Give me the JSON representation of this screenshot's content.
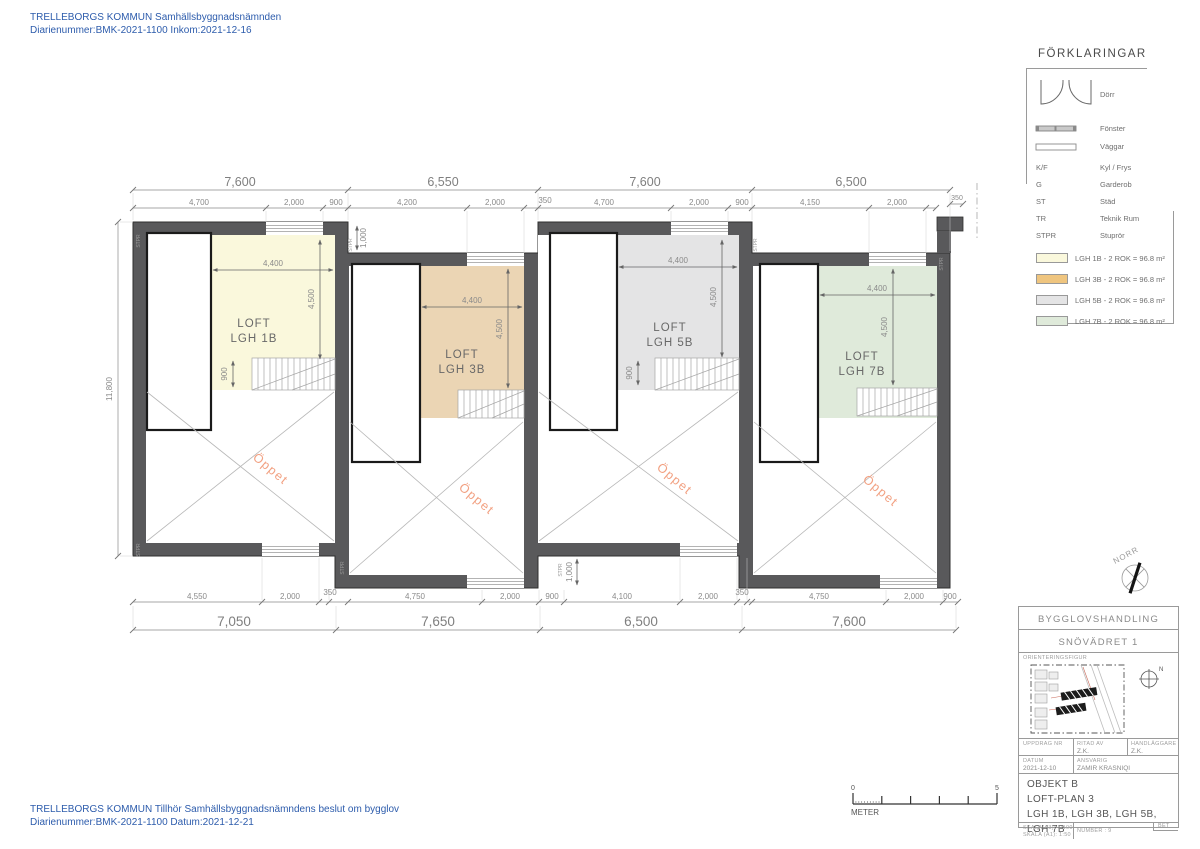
{
  "stamps": {
    "top": {
      "line1": "TRELLEBORGS KOMMUN Samhällsbyggnadsnämnden",
      "line2": "Diarienummer:BMK-2021-1100 Inkom:2021-12-16"
    },
    "bottom": {
      "line1": "TRELLEBORGS KOMMUN Tillhör Samhällsbyggnadsnämndens beslut om bygglov",
      "line2": "Diarienummer:BMK-2021-1100 Datum:2021-12-21"
    }
  },
  "legend": {
    "title": "FÖRKLARINGAR",
    "dorr": "Dörr",
    "fonster": "Fönster",
    "vaggar": "Väggar",
    "abbr": [
      {
        "key": "K/F",
        "value": "Kyl / Frys"
      },
      {
        "key": "G",
        "value": "Garderob"
      },
      {
        "key": "ST",
        "value": "Städ"
      },
      {
        "key": "TR",
        "value": "Teknik Rum"
      },
      {
        "key": "STPR",
        "value": "Stuprör"
      }
    ],
    "apartments": [
      {
        "label": "LGH 1B - 2 ROK = 96.8 m²",
        "color": "#f9f4cf"
      },
      {
        "label": "LGH 3B - 2 ROK = 96.8 m²",
        "color": "#f0c largo"
      },
      {
        "label": "LGH 5B - 2 ROK = 96.8 m²",
        "color": "#dedede"
      },
      {
        "label": "LGH 7B - 2 ROK = 96.8 m²",
        "color": "#d8e7d2"
      }
    ]
  },
  "plan": {
    "stpr": "STPR",
    "open": "Öppet",
    "left_total": "11,800",
    "offset": "1,000",
    "step": "350",
    "wall_color": "#59595b",
    "top_totals": [
      "7,600",
      "6,550",
      "7,600",
      "6,500"
    ],
    "top_subs": [
      [
        "4,700",
        "2,000",
        "900"
      ],
      [
        "4,200",
        "2,000",
        "350"
      ],
      [
        "4,700",
        "2,000",
        "900"
      ],
      [
        "4,150",
        "2,000",
        "350"
      ]
    ],
    "bottom_totals": [
      "7,050",
      "7,650",
      "6,500",
      "7,600"
    ],
    "bottom_subs": [
      [
        "4,550",
        "2,000",
        "350"
      ],
      [
        "4,750",
        "2,000",
        "900"
      ],
      [
        "4,100",
        "2,000",
        "350"
      ],
      [
        "4,750",
        "2,000",
        "900"
      ]
    ],
    "units": [
      {
        "l1": "LOFT",
        "l2": "LGH 1B",
        "w": "4,400",
        "h": "4,500",
        "s": "900",
        "fill": "#faf8dc"
      },
      {
        "l1": "LOFT",
        "l2": "LGH 3B",
        "w": "4,400",
        "h": "4,500",
        "fill": "#ebd5b4"
      },
      {
        "l1": "LOFT",
        "l2": "LGH 5B",
        "w": "4,400",
        "h": "4,500",
        "s": "900",
        "fill": "#e4e4e5"
      },
      {
        "l1": "LOFT",
        "l2": "LGH 7B",
        "w": "4,400",
        "h": "4,500",
        "fill": "#dfeada"
      }
    ]
  },
  "north": {
    "label": "NORR",
    "n": "N"
  },
  "scalebar": {
    "zero": "0",
    "five": "5",
    "unit": "METER"
  },
  "titleblock": {
    "doc_type": "BYGGLOVSHANDLING",
    "property": "SNÖVÄDRET 1",
    "orientation": "ORIENTERINGSFIGUR",
    "uppdrag_label": "UPPDRAG NR",
    "ritad_label": "RITAD AV",
    "ritad_value": "Z.K.",
    "handlaggare_label": "HANDLÄGGARE",
    "handlaggare_value": "Z.K.",
    "datum_label": "DATUM",
    "datum_value": "2021-12-10",
    "ansvarig_label": "ANSVARIG",
    "ansvarig_value": "ZAMIR KRASNIQI",
    "obj1": "OBJEKT B",
    "obj2": "LOFT-PLAN 3",
    "obj3": "LGH 1B, LGH 3B, LGH 5B, LGH 7B",
    "scale1": "SKALA(A3): 1:100",
    "scale2": "SKALA (A1): 1:50",
    "number": "NUMBER : 9",
    "bet": "BET"
  }
}
